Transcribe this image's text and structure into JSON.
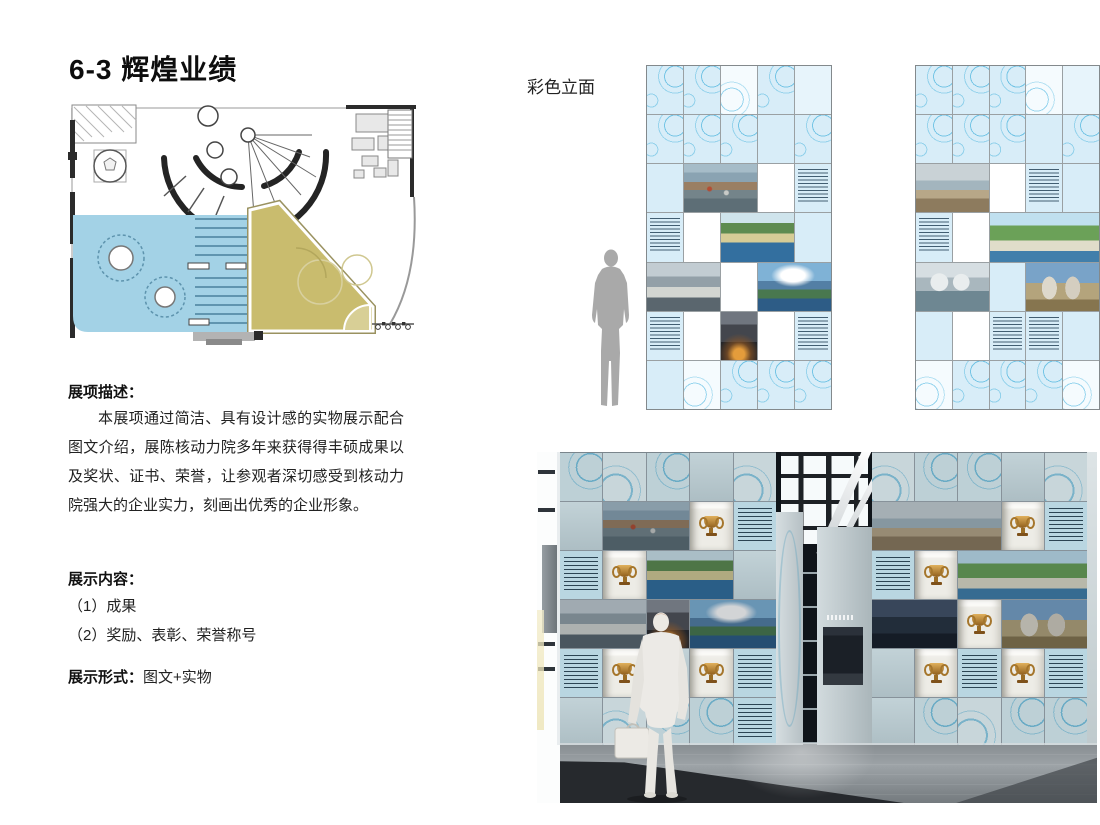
{
  "title": "6-3 辉煌业绩",
  "elevation_label": "彩色立面",
  "description": {
    "heading": "展项描述：",
    "body": "本展项通过简洁、具有设计感的实物展示配合图文介绍，展陈核动力院多年来获得得丰硕成果以及奖状、证书、荣誉，让参观者深切感受到核动力院强大的企业实力，刻画出优秀的企业形象。"
  },
  "content": {
    "heading": "展示内容：",
    "items": [
      "（1）成果",
      "（2）奖励、表彰、荣誉称号"
    ]
  },
  "format": {
    "label": "展示形式：",
    "value": "图文+实物"
  },
  "colors": {
    "plan_zone_blue": "#a3d2e6",
    "plan_zone_khaki": "#c9bc6e",
    "elevation_tile_blue": "#d8edf8",
    "blueprint_line": "#64bee2",
    "render_wall_tile": "#bdd0d6",
    "trophy_gold": "#c99a4a",
    "scale_figure_gray": "#a9a9a9"
  }
}
